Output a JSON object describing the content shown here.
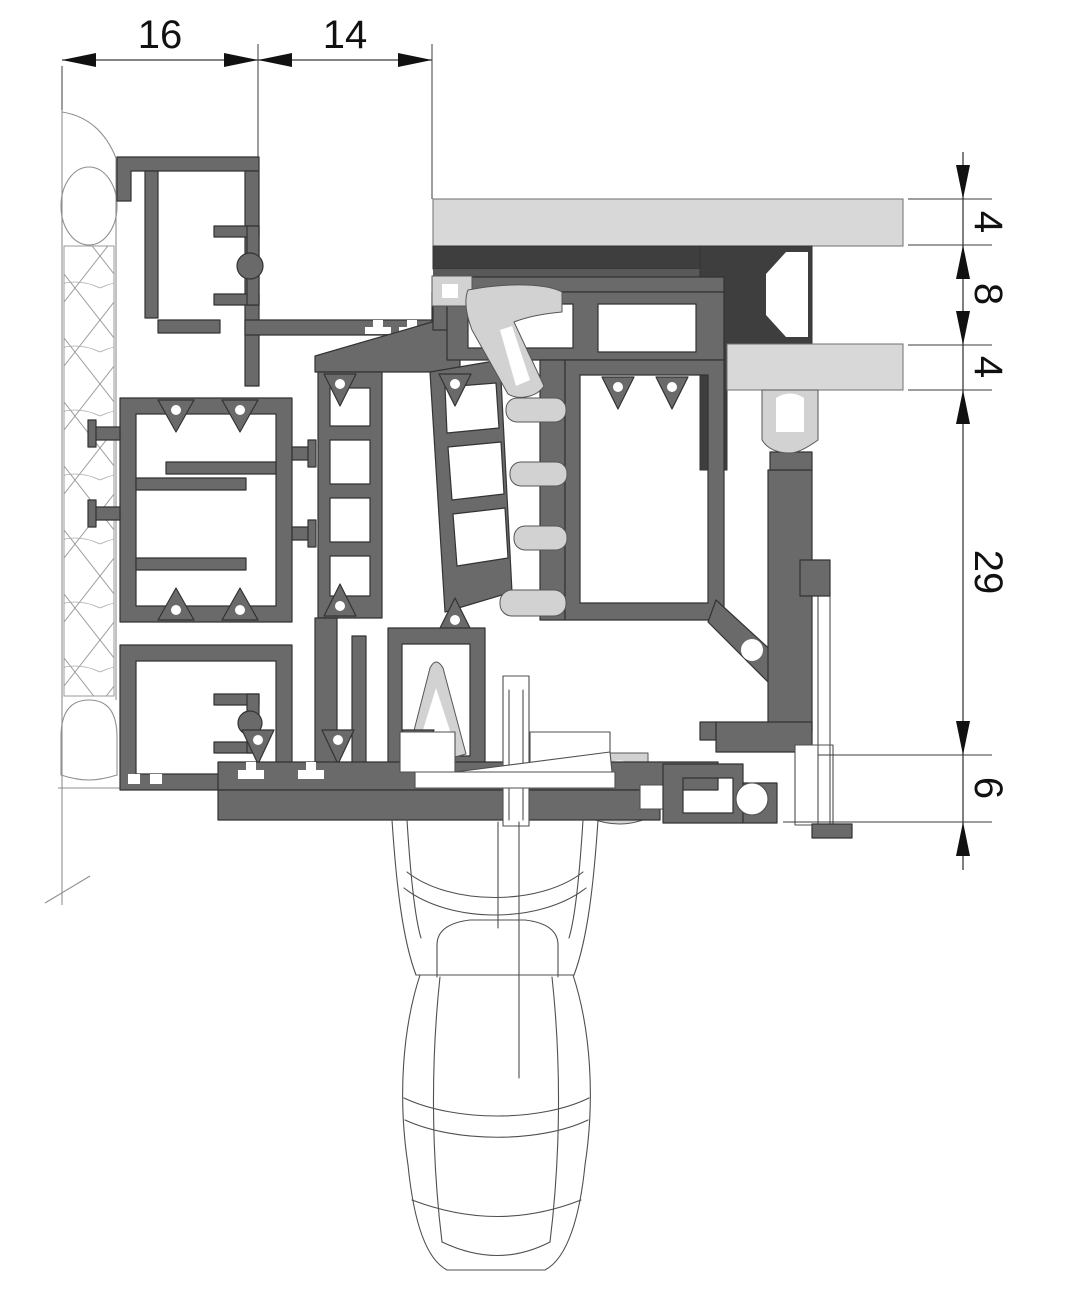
{
  "dimensions": {
    "top": [
      {
        "id": "dim-16",
        "label": "16"
      },
      {
        "id": "dim-14",
        "label": "14"
      }
    ],
    "right": [
      {
        "id": "dim-4-upper",
        "label": "4"
      },
      {
        "id": "dim-8",
        "label": "8"
      },
      {
        "id": "dim-4-lower",
        "label": "4"
      },
      {
        "id": "dim-29",
        "label": "29"
      },
      {
        "id": "dim-6",
        "label": "6"
      }
    ]
  },
  "colors": {
    "background": "#ffffff",
    "profile": "#6a6a6a",
    "profile_dark": "#3e3e3e",
    "profile_medium": "#595959",
    "glass": "#d8d8d8",
    "gasket": "#d2d2d2",
    "outline": "#333333",
    "thin": "#6f6f6f",
    "wall_line": "#8f8f8f",
    "dim_line": "#3c3c3c",
    "dim_text": "#111111"
  }
}
